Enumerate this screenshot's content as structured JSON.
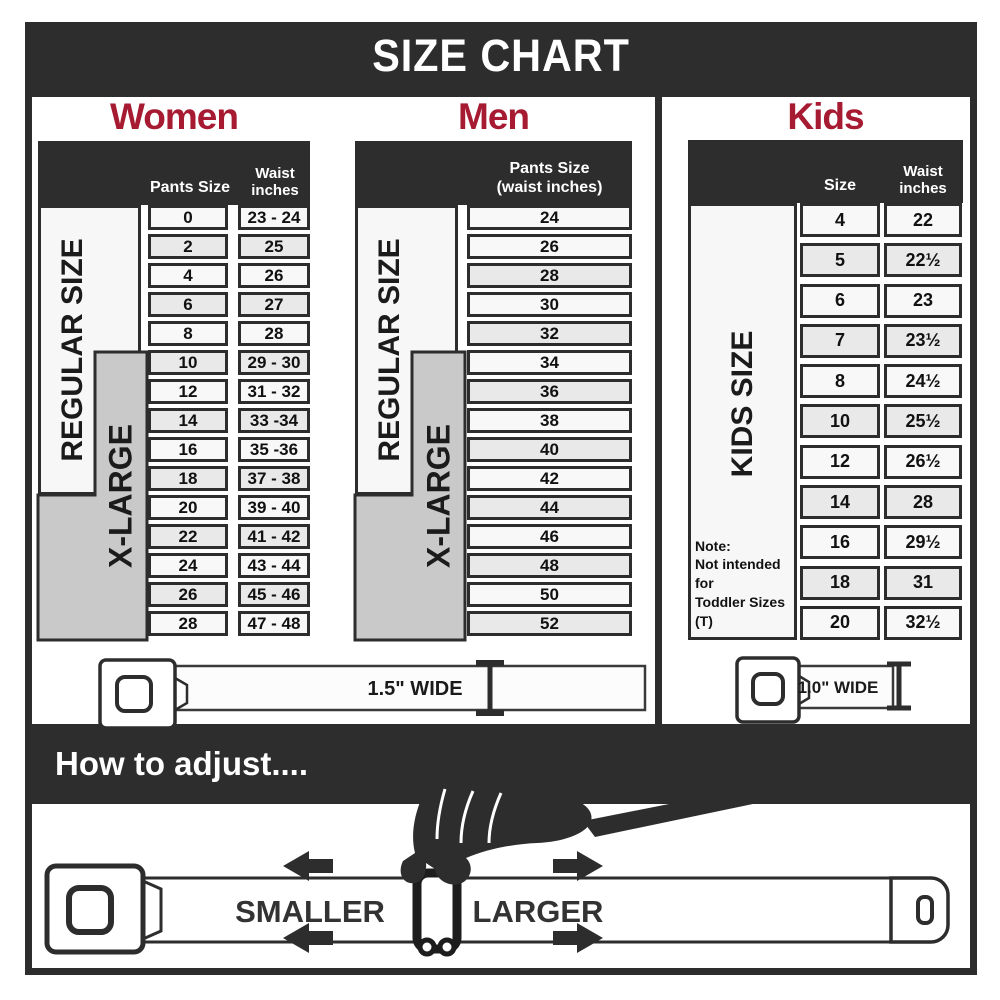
{
  "banner": {
    "title": "SIZE CHART"
  },
  "sections": {
    "women": {
      "title": "Women",
      "pants_size_header": "Pants Size",
      "waist_header_line1": "Waist",
      "waist_header_line2": "inches",
      "regular_label": "REGULAR SIZE",
      "xlarge_label": "X-LARGE",
      "rows": [
        [
          "0",
          "23 - 24"
        ],
        [
          "2",
          "25"
        ],
        [
          "4",
          "26"
        ],
        [
          "6",
          "27"
        ],
        [
          "8",
          "28"
        ],
        [
          "10",
          "29 - 30"
        ],
        [
          "12",
          "31 - 32"
        ],
        [
          "14",
          "33 -34"
        ],
        [
          "16",
          "35 -36"
        ],
        [
          "18",
          "37 - 38"
        ],
        [
          "20",
          "39 - 40"
        ],
        [
          "22",
          "41 - 42"
        ],
        [
          "24",
          "43 - 44"
        ],
        [
          "26",
          "45 - 46"
        ],
        [
          "28",
          "47 - 48"
        ]
      ]
    },
    "men": {
      "title": "Men",
      "header_line1": "Pants Size",
      "header_line2": "(waist inches)",
      "regular_label": "REGULAR SIZE",
      "xlarge_label": "X-LARGE",
      "rows": [
        "24",
        "26",
        "28",
        "30",
        "32",
        "34",
        "36",
        "38",
        "40",
        "42",
        "44",
        "46",
        "48",
        "50",
        "52"
      ]
    },
    "kids": {
      "title": "Kids",
      "size_header": "Size",
      "waist_header_line1": "Waist",
      "waist_header_line2": "inches",
      "side_label": "KIDS SIZE",
      "note_line1": "Note:",
      "note_line2": "Not intended for",
      "note_line3": "Toddler Sizes (T)",
      "rows": [
        [
          "4",
          "22"
        ],
        [
          "5",
          "22½"
        ],
        [
          "6",
          "23"
        ],
        [
          "7",
          "23½"
        ],
        [
          "8",
          "24½"
        ],
        [
          "10",
          "25½"
        ],
        [
          "12",
          "26½"
        ],
        [
          "14",
          "28"
        ],
        [
          "16",
          "29½"
        ],
        [
          "18",
          "31"
        ],
        [
          "20",
          "32½"
        ]
      ]
    }
  },
  "belts": {
    "adult_label": "1.5\" WIDE",
    "kids_label": "1.0\" WIDE"
  },
  "adjust": {
    "heading": "How to adjust....",
    "smaller": "SMALLER",
    "larger": "LARGER"
  },
  "colors": {
    "dark": "#2d2d2d",
    "accent_red": "#a61a32",
    "xlarge_gray": "#c9c9c9",
    "row_light": "#f8f8f8",
    "row_alt": "#e9e9e9"
  }
}
